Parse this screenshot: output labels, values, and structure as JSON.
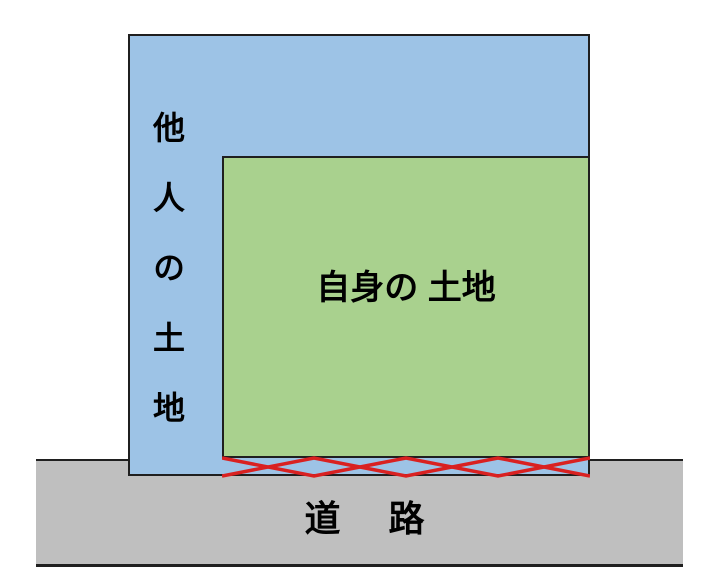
{
  "diagram": {
    "description": "land-access-diagram",
    "regions": {
      "other_land": {
        "label": "他人の土地",
        "fill": "#9DC3E6"
      },
      "own_land": {
        "label": "自身の 土地",
        "fill": "#A9D18E"
      },
      "road": {
        "label": "道　路",
        "fill": "#BFBFBF"
      }
    },
    "hatch": {
      "color": "#D92121"
    },
    "outline_color": "#1f1f1f",
    "text_color": "#000000"
  }
}
